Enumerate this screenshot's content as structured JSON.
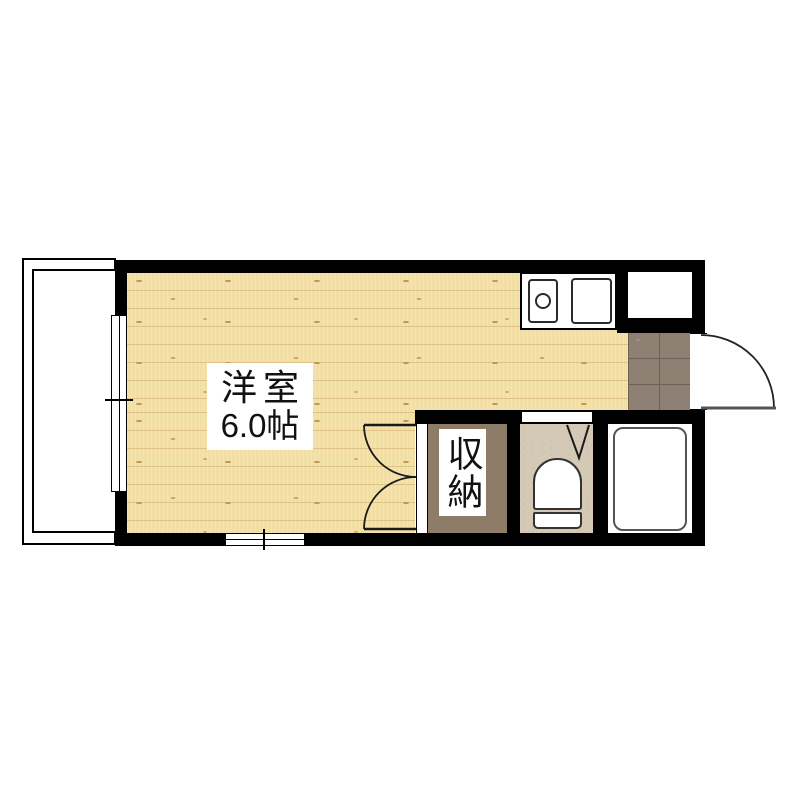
{
  "plan": {
    "type": "apartment-floorplan",
    "rooms": {
      "main": {
        "name": "洋室",
        "size": "6.0帖",
        "floor": "wood"
      },
      "closet": {
        "name": "収納",
        "floor": "brown"
      },
      "kitchen": {
        "fixtures": [
          "burner",
          "sink"
        ]
      },
      "entry": {
        "floor": "tile",
        "door": "outward-swing"
      },
      "toilet": {
        "fixtures": [
          "toilet"
        ],
        "door": "v-symbol"
      },
      "bathroom": {
        "fixtures": [
          "bathtub"
        ]
      },
      "balcony": {
        "railing": "double-line"
      },
      "storage_box": {
        "floor": "white"
      }
    },
    "colors": {
      "background": "#ffffff",
      "wall": "#000000",
      "wood": "#f2dfa6",
      "wood-knot": "#bf9a55",
      "tile": "#8e8174",
      "tile-grout": "#6c6154",
      "closet-floor": "#8d7c68",
      "toilet-floor": "#d3c9b4",
      "fixture-outline": "#2a2a2a",
      "tub-outline": "#555555",
      "door-line": "#222222"
    }
  }
}
